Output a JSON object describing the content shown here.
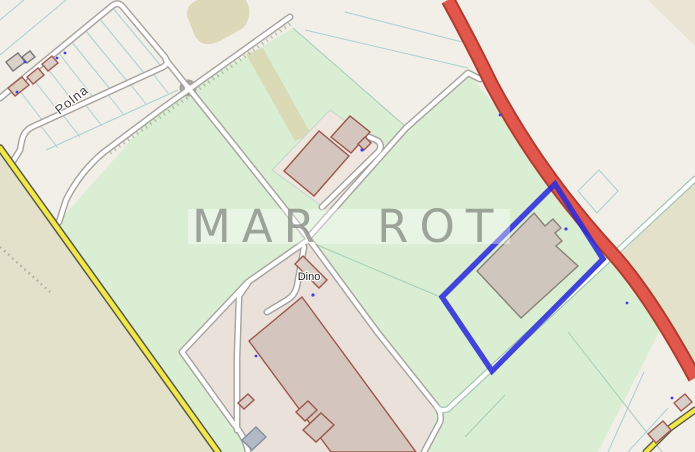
{
  "map": {
    "labels": {
      "street": "Polna",
      "poi": "Dino",
      "watermark": "MAR ROT"
    },
    "colors": {
      "background": "#f2efe9",
      "grass": "#daeed3",
      "farmland": "#e4e1ca",
      "scrub": "#dcd8b8",
      "industrial": "#eae1da",
      "yard": "#efe7df",
      "building_fill": "#d4c5bf",
      "building_stroke": "#9c564d",
      "gray_building_fill": "#cfc6bd",
      "gray_building_stroke": "#8b8177",
      "primary_road_fill": "#e2574b",
      "primary_road_casing": "#b03c30",
      "secondary_road_fill": "#f2e74a",
      "secondary_road_casing": "#565644",
      "minor_road_fill": "#ffffff",
      "minor_road_casing": "#a6a29e",
      "track_casing": "#9fc4b4",
      "parcel_line": "#a9d0d2",
      "field_line": "#a5cdbb",
      "highlight_outline": "#2a2cd8",
      "address_dot": "#4040e8",
      "watermark_color": "#878d83",
      "label_color": "#333333"
    }
  }
}
